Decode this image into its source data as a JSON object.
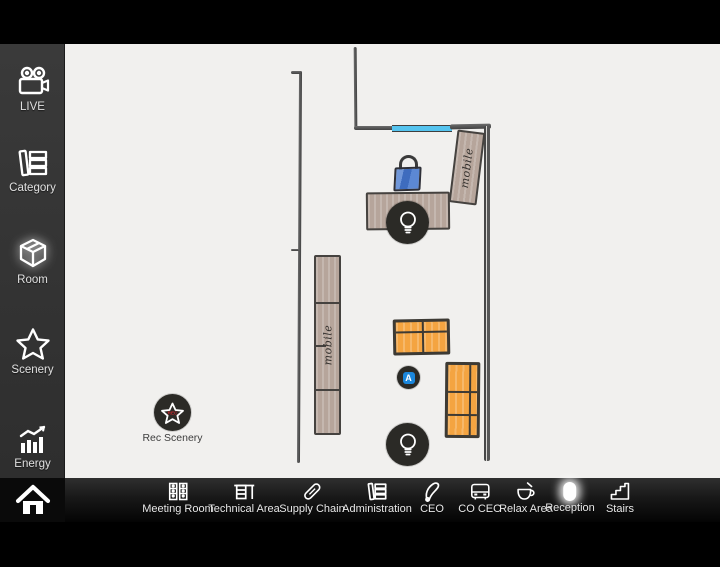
{
  "sidebar": {
    "items": [
      {
        "label": "LIVE",
        "icon": "video-camera-icon"
      },
      {
        "label": "Category",
        "icon": "category-books-icon"
      },
      {
        "label": "Room",
        "icon": "room-cube-icon",
        "selected": true
      },
      {
        "label": "Scenery",
        "icon": "scenery-star-icon"
      },
      {
        "label": "Energy",
        "icon": "energy-chart-icon"
      }
    ],
    "home": {
      "icon": "home-icon"
    }
  },
  "bottom_bar": {
    "items": [
      {
        "label": "Meeting Room",
        "icon": "meeting-room-icon"
      },
      {
        "label": "Technical Area",
        "icon": "technical-area-icon"
      },
      {
        "label": "Supply Chain",
        "icon": "supply-chain-icon"
      },
      {
        "label": "Administration",
        "icon": "administration-icon"
      },
      {
        "label": "CEO",
        "icon": "ceo-icon"
      },
      {
        "label": "CO CEO",
        "icon": "co-ceo-icon"
      },
      {
        "label": "Relax Area",
        "icon": "relax-area-icon"
      },
      {
        "label": "Reception",
        "icon": "reception-icon",
        "highlighted": true
      },
      {
        "label": "Stairs",
        "icon": "stairs-icon"
      }
    ]
  },
  "floorplan": {
    "cabinets": [
      {
        "label": "mobile"
      },
      {
        "label": "mobile"
      }
    ],
    "markers": [
      {
        "name": "light-top",
        "icon": "lightbulb-icon"
      },
      {
        "name": "automation",
        "label": "A",
        "icon": "automation-badge"
      },
      {
        "name": "light-bottom",
        "icon": "lightbulb-icon"
      },
      {
        "name": "rec-scenery",
        "label": "Rec Scenery",
        "badge": "REC",
        "icon": "star-icon"
      }
    ],
    "colors": {
      "floor": "#f1f0ee",
      "wall": "#4b4b4b",
      "window_blue": "#55c4ef",
      "furniture_taupe": "#b6a59b",
      "table_orange": "#f4a441",
      "marker_dark": "#2b2a26",
      "chair_blue": "#4d7ecb",
      "automation_blue": "#1b87dc",
      "rec_red": "#c2242a"
    }
  }
}
